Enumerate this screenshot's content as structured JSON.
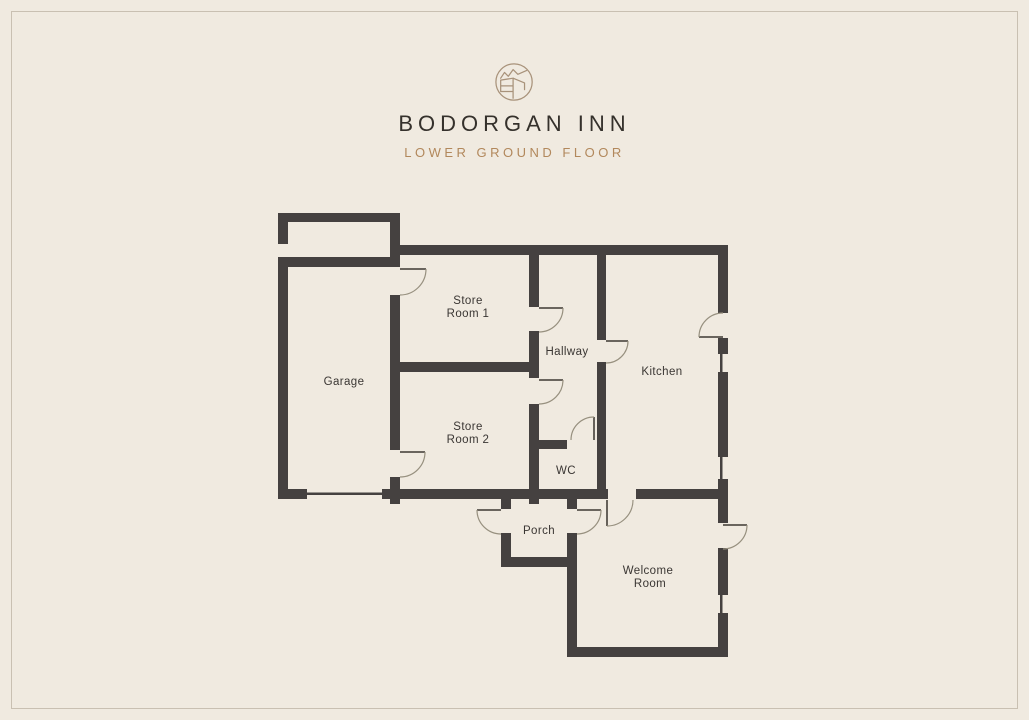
{
  "header": {
    "title": "BODORGAN INN",
    "subtitle": "LOWER GROUND FLOOR",
    "logo": "circle-landscape-mark-icon"
  },
  "rooms": {
    "garage": "Garage",
    "store_room_1": [
      "Store",
      "Room 1"
    ],
    "hallway": "Hallway",
    "kitchen": "Kitchen",
    "store_room_2": [
      "Store",
      "Room 2"
    ],
    "wc": "WC",
    "porch": "Porch",
    "welcome_room": [
      "Welcome",
      "Room"
    ]
  },
  "colors": {
    "background": "#f0eae0",
    "wall": "#454140",
    "title": "#35312c",
    "accent": "#b2885c",
    "label": "#3a3633",
    "border": "#c9c0b2",
    "doorarc": "#97907f"
  }
}
